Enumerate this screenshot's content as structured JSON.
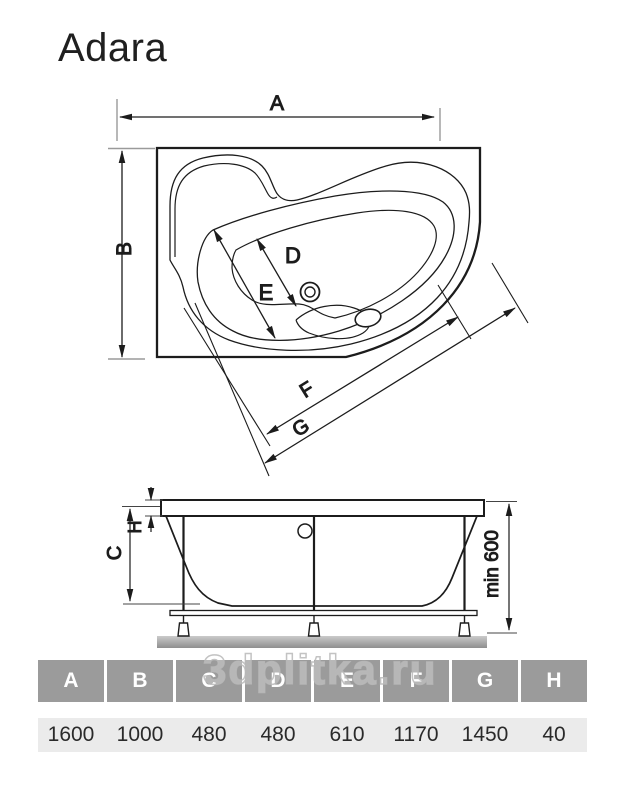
{
  "title": "Adara",
  "watermark": "3dplitka.ru",
  "top_view": {
    "dim_labels": {
      "a": "A",
      "b": "B",
      "d": "D",
      "e": "E",
      "f": "F",
      "g": "G"
    }
  },
  "side_view": {
    "dim_labels": {
      "h": "H",
      "c": "C"
    },
    "min_height_label": "min 600"
  },
  "table": {
    "headers": [
      "A",
      "B",
      "C",
      "D",
      "E",
      "F",
      "G",
      "H"
    ],
    "values": [
      "1600",
      "1000",
      "480",
      "480",
      "610",
      "1170",
      "1450",
      "40"
    ]
  },
  "colors": {
    "line": "#1c1c1c",
    "extension_line": "#9a9a9a",
    "table_header_bg": "#9b9b9b",
    "table_header_text": "#ffffff",
    "table_row_bg": "#ebebeb",
    "watermark": "#c8c8c8"
  }
}
